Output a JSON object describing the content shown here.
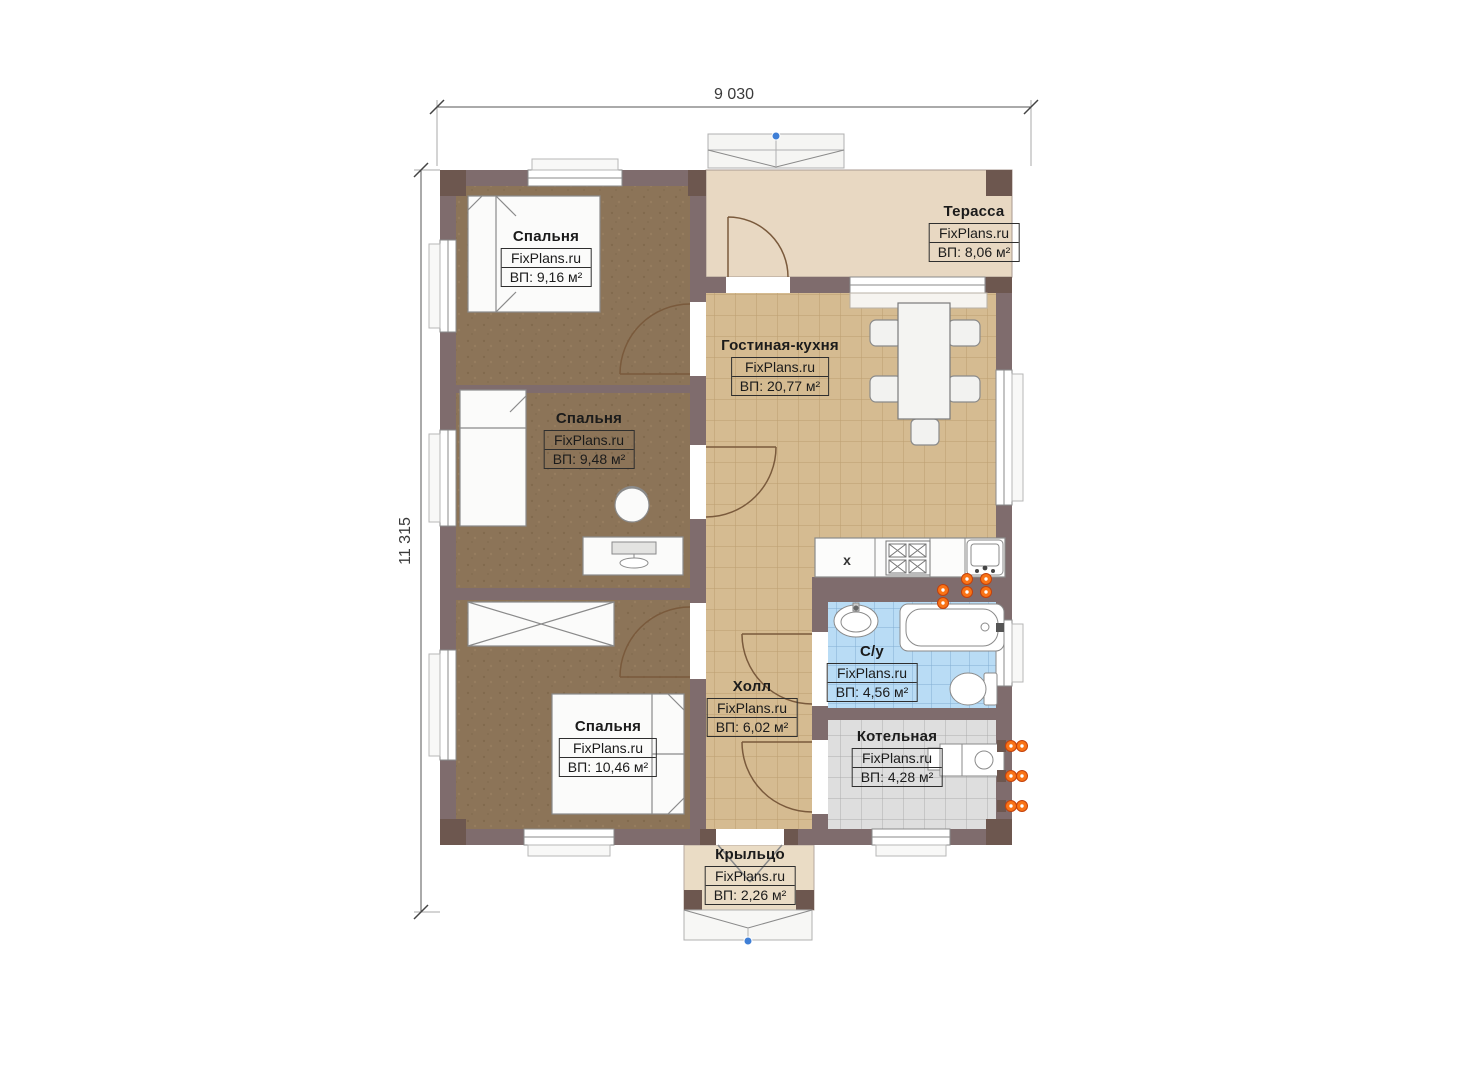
{
  "plan": {
    "dimensions": {
      "width": "9 030",
      "height": "11 315"
    },
    "kitchen_marker": "х",
    "rooms": [
      {
        "name": "Спальня",
        "brand": "FixPlans.ru",
        "area": "ВП: 9,16 м²"
      },
      {
        "name": "Терасса",
        "brand": "FixPlans.ru",
        "area": "ВП: 8,06 м²"
      },
      {
        "name": "Гостиная-кухня",
        "brand": "FixPlans.ru",
        "area": "ВП: 20,77 м²"
      },
      {
        "name": "Спальня",
        "brand": "FixPlans.ru",
        "area": "ВП: 9,48 м²"
      },
      {
        "name": "Спальня",
        "brand": "FixPlans.ru",
        "area": "ВП: 10,46 м²"
      },
      {
        "name": "Холл",
        "brand": "FixPlans.ru",
        "area": "ВП: 6,02 м²"
      },
      {
        "name": "С/у",
        "brand": "FixPlans.ru",
        "area": "ВП: 4,56 м²"
      },
      {
        "name": "Котельная",
        "brand": "FixPlans.ru",
        "area": "ВП: 4,28 м²"
      },
      {
        "name": "Крыльцо",
        "brand": "FixPlans.ru",
        "area": "ВП: 2,26 м²"
      }
    ],
    "palette": {
      "wall": "#7f6c6d",
      "wall_pillar": "#6d574f",
      "bedroom_floor": "#8c7458",
      "tile_tan": "#d5bb91",
      "tile_blue": "#b9dcf5",
      "tile_gray": "#dedede",
      "terrace_floor": "#e8d8c2",
      "porch_floor": "#eadcc5",
      "radiator": "#f97316",
      "axis_dot": "#3f7fd6"
    }
  }
}
